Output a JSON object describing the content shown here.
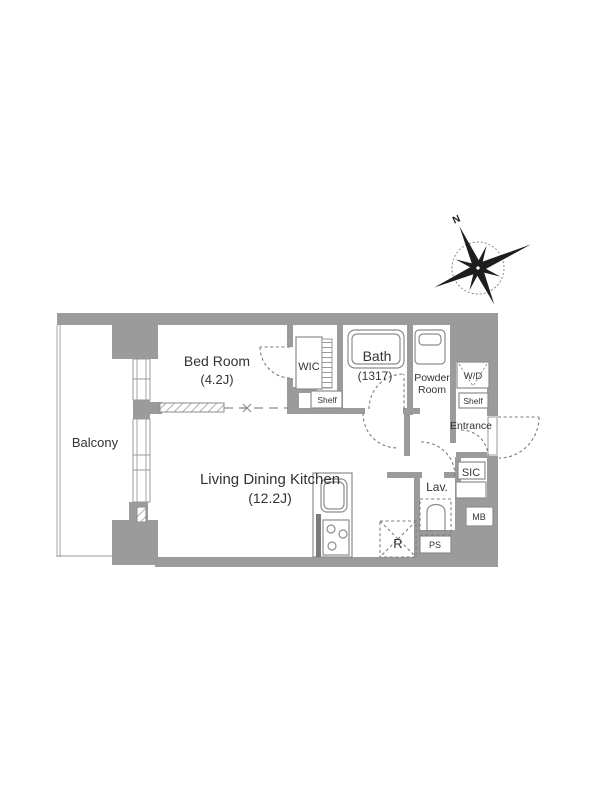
{
  "compass": {
    "north": "N"
  },
  "rooms": {
    "balcony": {
      "label": "Balcony"
    },
    "bedroom": {
      "label": "Bed Room",
      "size": "(4.2J)"
    },
    "living_dining_kitchen": {
      "label": "Living Dining Kitchen",
      "size": "(12.2J)"
    },
    "wic": {
      "label": "WIC"
    },
    "wic_shelf": {
      "label": "Shelf"
    },
    "bath": {
      "label": "Bath",
      "size": "(1317)"
    },
    "powder_room": {
      "line1": "Powder",
      "line2": "Room"
    },
    "washer_dryer": {
      "label": "W/D"
    },
    "entry_shelf": {
      "label": "Shelf"
    },
    "entrance": {
      "label": "Entrance"
    },
    "sic": {
      "label": "SIC"
    },
    "lavatory": {
      "label": "Lav."
    },
    "meter_box": {
      "label": "MB"
    },
    "pipe_space": {
      "label": "PS"
    },
    "refrigerator": {
      "label": "R"
    }
  },
  "colors": {
    "wall": "#9b9b9b",
    "line": "#8c8c8c",
    "text": "#333333"
  }
}
